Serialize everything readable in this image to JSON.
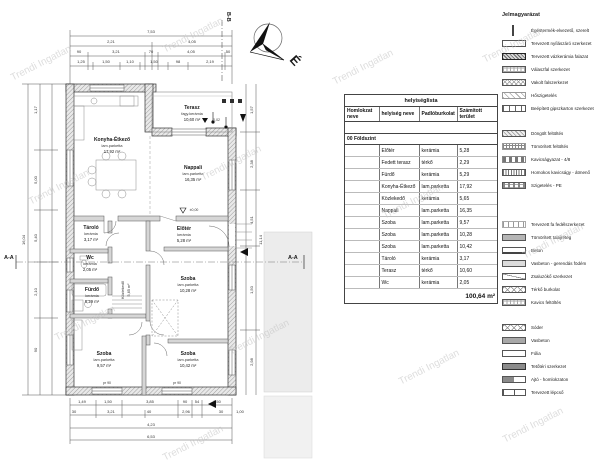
{
  "watermark": {
    "text": "Trendi Ingatlan"
  },
  "plan": {
    "section_marker_top": "B-B",
    "section_marker_side_left": "A-A",
    "section_marker_side_right": "A-A",
    "north_letter": "É",
    "rooms": {
      "terasz": {
        "name": "Terasz",
        "floor": "fagy.kerámia",
        "area": "10,60 m²"
      },
      "konyha": {
        "name": "Konyha-Étkező",
        "floor": "lam.parketta",
        "area": "17,92 m²"
      },
      "nappali": {
        "name": "Nappali",
        "floor": "lam.parketta",
        "area": "16,35 m²"
      },
      "eloter": {
        "name": "Előtér",
        "floor": "kerámia",
        "area": "5,28 m²"
      },
      "tarolo": {
        "name": "Tároló",
        "floor": "kerámia",
        "area": "3,17 m²"
      },
      "wc": {
        "name": "Wc",
        "floor": "kerámia",
        "area": "2,05 m²"
      },
      "furdo": {
        "name": "Fürdő",
        "floor": "kerámia",
        "area": "5,29 m²"
      },
      "kozlekedo": {
        "name": "Közlekedő",
        "floor": "kerámia",
        "area": "5,65 m²"
      },
      "szoba1": {
        "name": "Szoba",
        "floor": "lam.parketta",
        "area": "10,28 m²"
      },
      "szoba2": {
        "name": "Szoba",
        "floor": "lam.parketta",
        "area": "9,57 m²"
      },
      "szoba3": {
        "name": "Szoba",
        "floor": "lam.parketta",
        "area": "10,42 m²"
      }
    },
    "levels": [
      "±0,00",
      "-0,02"
    ],
    "parapet": "pr 90",
    "dims": {
      "top1": [
        "7,53"
      ],
      "top2": [
        "2,21",
        "4,05"
      ],
      "top3": [
        "90",
        "3,21",
        "70",
        "4,05",
        "50"
      ],
      "top4": [
        "1,25",
        "1,50",
        "1,10",
        "1,50",
        "98",
        "2,19"
      ],
      "left": [
        "1,17",
        "5,00",
        "5,40",
        "2,10",
        "90",
        "16,04"
      ],
      "right": [
        "1,57",
        "2,38",
        "4,51",
        "1,50",
        "2,98",
        "11,14"
      ],
      "bottom1": [
        "1,49",
        "1,50",
        "3,85",
        "90",
        "54",
        "1,50"
      ],
      "bottom2": [
        "30",
        "3,21",
        "40",
        "2,96",
        "30",
        "1,00"
      ],
      "bottom3": [
        "4,23",
        "6,53"
      ]
    }
  },
  "table": {
    "title": "helyiséglista",
    "columns": [
      "Homlokzat neve",
      "helyiség neve",
      "Padlóburkolat",
      "Számított terület"
    ],
    "group": "00 Földszint",
    "rows": [
      {
        "name": "Előtér",
        "floor": "kerámia",
        "area": "5,28"
      },
      {
        "name": "Fedett terasz",
        "floor": "térkő",
        "area": "2,29"
      },
      {
        "name": "Fürdő",
        "floor": "kerámia",
        "area": "5,29"
      },
      {
        "name": "Konyha-Étkező",
        "floor": "lam.parketta",
        "area": "17,92"
      },
      {
        "name": "Közlekedő",
        "floor": "kerámia",
        "area": "5,65"
      },
      {
        "name": "Nappali",
        "floor": "lam.parketta",
        "area": "16,35"
      },
      {
        "name": "Szoba",
        "floor": "lam.parketta",
        "area": "9,57"
      },
      {
        "name": "Szoba",
        "floor": "lam.parketta",
        "area": "10,28"
      },
      {
        "name": "Szoba",
        "floor": "lam.parketta",
        "area": "10,42"
      },
      {
        "name": "Tároló",
        "floor": "kerámia",
        "area": "3,17"
      },
      {
        "name": "Terasz",
        "floor": "térkő",
        "area": "10,60"
      },
      {
        "name": "Wc",
        "floor": "kerámia",
        "area": "2,05"
      }
    ],
    "total": "100,64 m²"
  },
  "legend": {
    "title": "Jelmagyarázat",
    "items": [
      {
        "label": "Égéstermék-elvezető, szerelt",
        "swatch": "vline"
      },
      {
        "label": "Tervezett nyílászáró szerkezet",
        "swatch": "outline"
      },
      {
        "label": "Tervezett vázkerámia falazat",
        "swatch": "hatch-dark"
      },
      {
        "label": "Válaszfal szerkezet",
        "swatch": "dots-outline"
      },
      {
        "label": "Vakolt falszerkezet",
        "swatch": "cross"
      },
      {
        "label": "Hőszigetelés",
        "swatch": "diag-light"
      },
      {
        "label": "Beépített gipszkarton szerkezet",
        "swatch": "ticks"
      },
      {
        "label": "Döngölt feltöltés",
        "swatch": "hatch"
      },
      {
        "label": "Tömörített feltöltés",
        "swatch": "dots"
      },
      {
        "label": "Kavicságyazat - 4/8",
        "swatch": "dashes"
      },
      {
        "label": "Homokos kavicságy - átmenő",
        "swatch": "vlines"
      },
      {
        "label": "Szigetelés - PE",
        "swatch": "dots-dash"
      },
      {
        "label": "Tervezett fa fedélszerkezet",
        "swatch": "ticks-light"
      },
      {
        "label": "Tömörített talajréteg",
        "swatch": "solid-mid"
      },
      {
        "label": "Beton",
        "swatch": "outline-b"
      },
      {
        "label": "Vasbeton - gerendás födém",
        "swatch": "solid-light"
      },
      {
        "label": "Zsaluzókő szerkezet",
        "swatch": "diag-one"
      },
      {
        "label": "Térkő burkolat",
        "swatch": "diamond"
      },
      {
        "label": "Kavics feltöltés",
        "swatch": "dots-outline"
      },
      {
        "label": "Sóder",
        "swatch": "diamond"
      },
      {
        "label": "Vasbeton",
        "swatch": "solid-mid2"
      },
      {
        "label": "Fólia",
        "swatch": "outline"
      },
      {
        "label": "Tetőtéri szerkezet",
        "swatch": "solid-dark"
      },
      {
        "label": "Ajtó - homlokzaton",
        "swatch": "half"
      },
      {
        "label": "Tervezett lépcső",
        "swatch": "step"
      }
    ]
  }
}
